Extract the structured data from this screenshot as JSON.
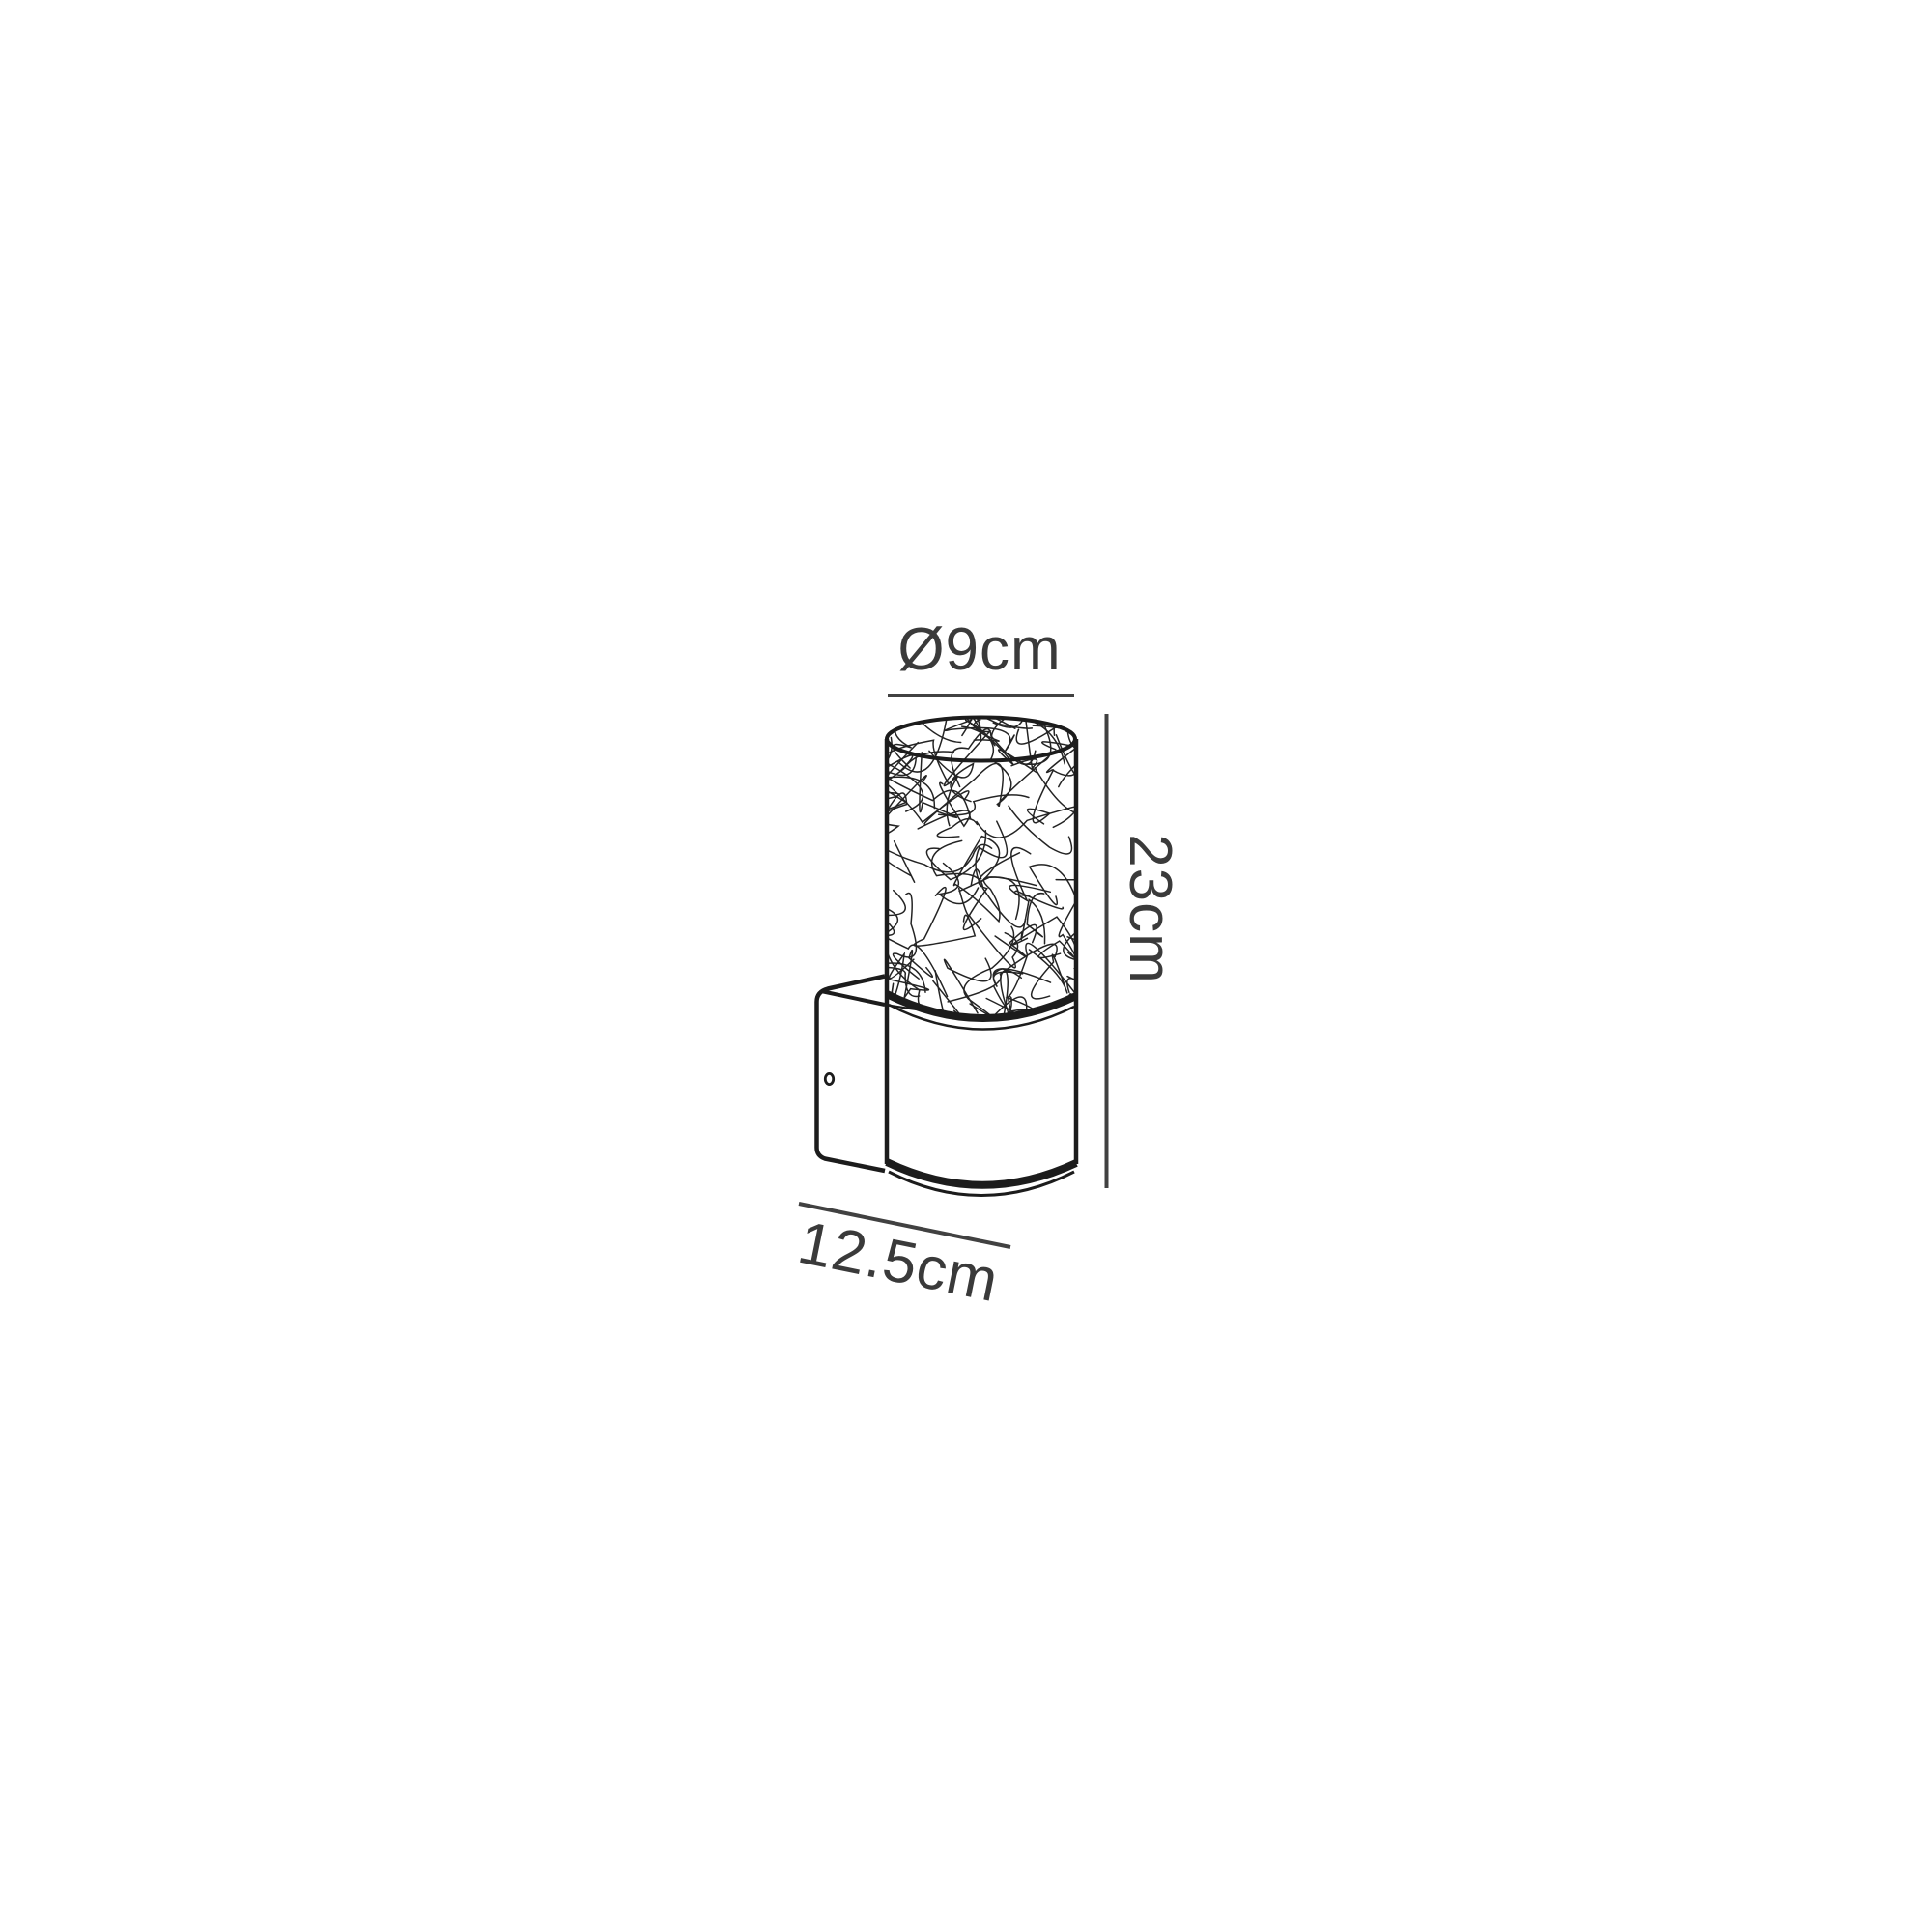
{
  "page": {
    "background_color": "#ffffff",
    "content": "technical-dimension-diagram"
  },
  "drawing": {
    "subject": "cylindrical-wall-light-with-crackle-glass-shade-and-mounting-plate",
    "style": "black-line-art",
    "stroke_color": "#1c1c1c",
    "dimension_line_color": "#414141",
    "text_color": "#3a3a3a",
    "labels": {
      "diameter": "Ø9cm",
      "height": "23cm",
      "width": "12.5cm"
    },
    "dimensions_cm": {
      "diameter": 9,
      "height": 23,
      "width": 12.5
    }
  }
}
